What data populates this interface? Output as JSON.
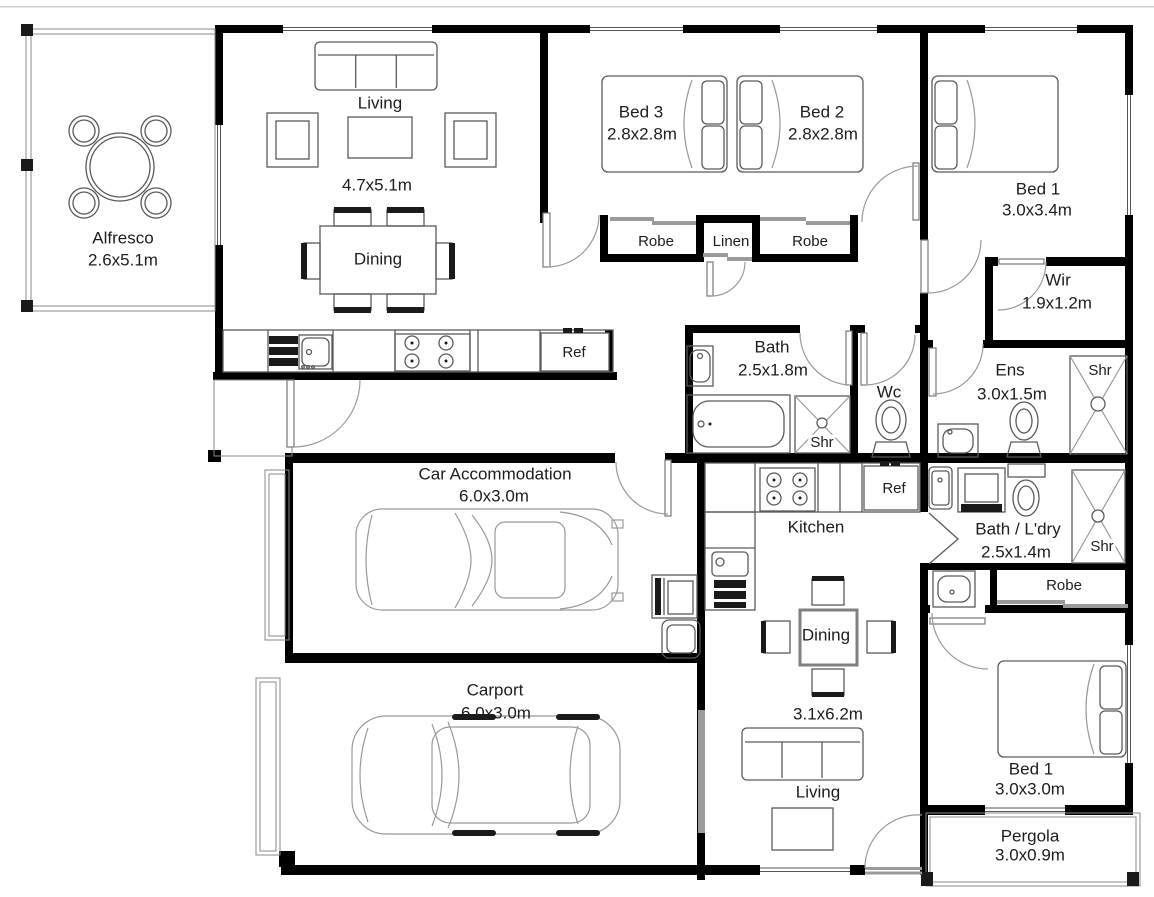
{
  "plan": {
    "rooms": {
      "alfresco": {
        "name": "Alfresco",
        "size": "2.6x5.1m"
      },
      "living_main": {
        "name": "Living",
        "size": "4.7x5.1m"
      },
      "dining_main": {
        "name": "Dining"
      },
      "bed3": {
        "name": "Bed 3",
        "size": "2.8x2.8m"
      },
      "bed2": {
        "name": "Bed 2",
        "size": "2.8x2.8m"
      },
      "bed1_main": {
        "name": "Bed 1",
        "size": "3.0x3.4m"
      },
      "robe_bed3": {
        "name": "Robe"
      },
      "linen": {
        "name": "Linen"
      },
      "robe_bed2": {
        "name": "Robe"
      },
      "wir": {
        "name": "Wir",
        "size": "1.9x1.2m"
      },
      "bath_main": {
        "name": "Bath",
        "size": "2.5x1.8m"
      },
      "shower_bath": {
        "name": "Shr"
      },
      "wc": {
        "name": "Wc"
      },
      "ens": {
        "name": "Ens",
        "size": "3.0x1.5m"
      },
      "shower_ens": {
        "name": "Shr"
      },
      "fridge_main": {
        "name": "Ref"
      },
      "car_accommodation": {
        "name": "Car Accommodation",
        "size": "6.0x3.0m"
      },
      "kitchen_unit": {
        "name": "Kitchen"
      },
      "fridge_unit": {
        "name": "Ref"
      },
      "bath_laundry": {
        "name": "Bath / L'dry",
        "size": "2.5x1.4m"
      },
      "shower_unit": {
        "name": "Shr"
      },
      "robe_unit": {
        "name": "Robe"
      },
      "dining_unit": {
        "name": "Dining",
        "size": "3.1x6.2m"
      },
      "living_unit": {
        "name": "Living"
      },
      "bed1_unit": {
        "name": "Bed 1",
        "size": "3.0x3.0m"
      },
      "pergola": {
        "name": "Pergola",
        "size": "3.0x0.9m"
      },
      "carport": {
        "name": "Carport",
        "size": "6.0x3.0m"
      }
    },
    "colors": {
      "wall": "#000000",
      "furniture_line": "#5a5a5a",
      "light_line": "#999999",
      "text": "#1d1d1f",
      "background": "#ffffff"
    },
    "furniture_icons": [
      "sofa",
      "armchair",
      "coffee-table",
      "dining-table",
      "round-table",
      "bed",
      "pillow",
      "sliding-robe-door",
      "cooktop",
      "kitchen-sink",
      "fridge",
      "bathtub",
      "shower",
      "toilet",
      "vanity-sink",
      "washing-machine",
      "laundry-tub",
      "car-top-view",
      "door-swing",
      "window"
    ]
  }
}
